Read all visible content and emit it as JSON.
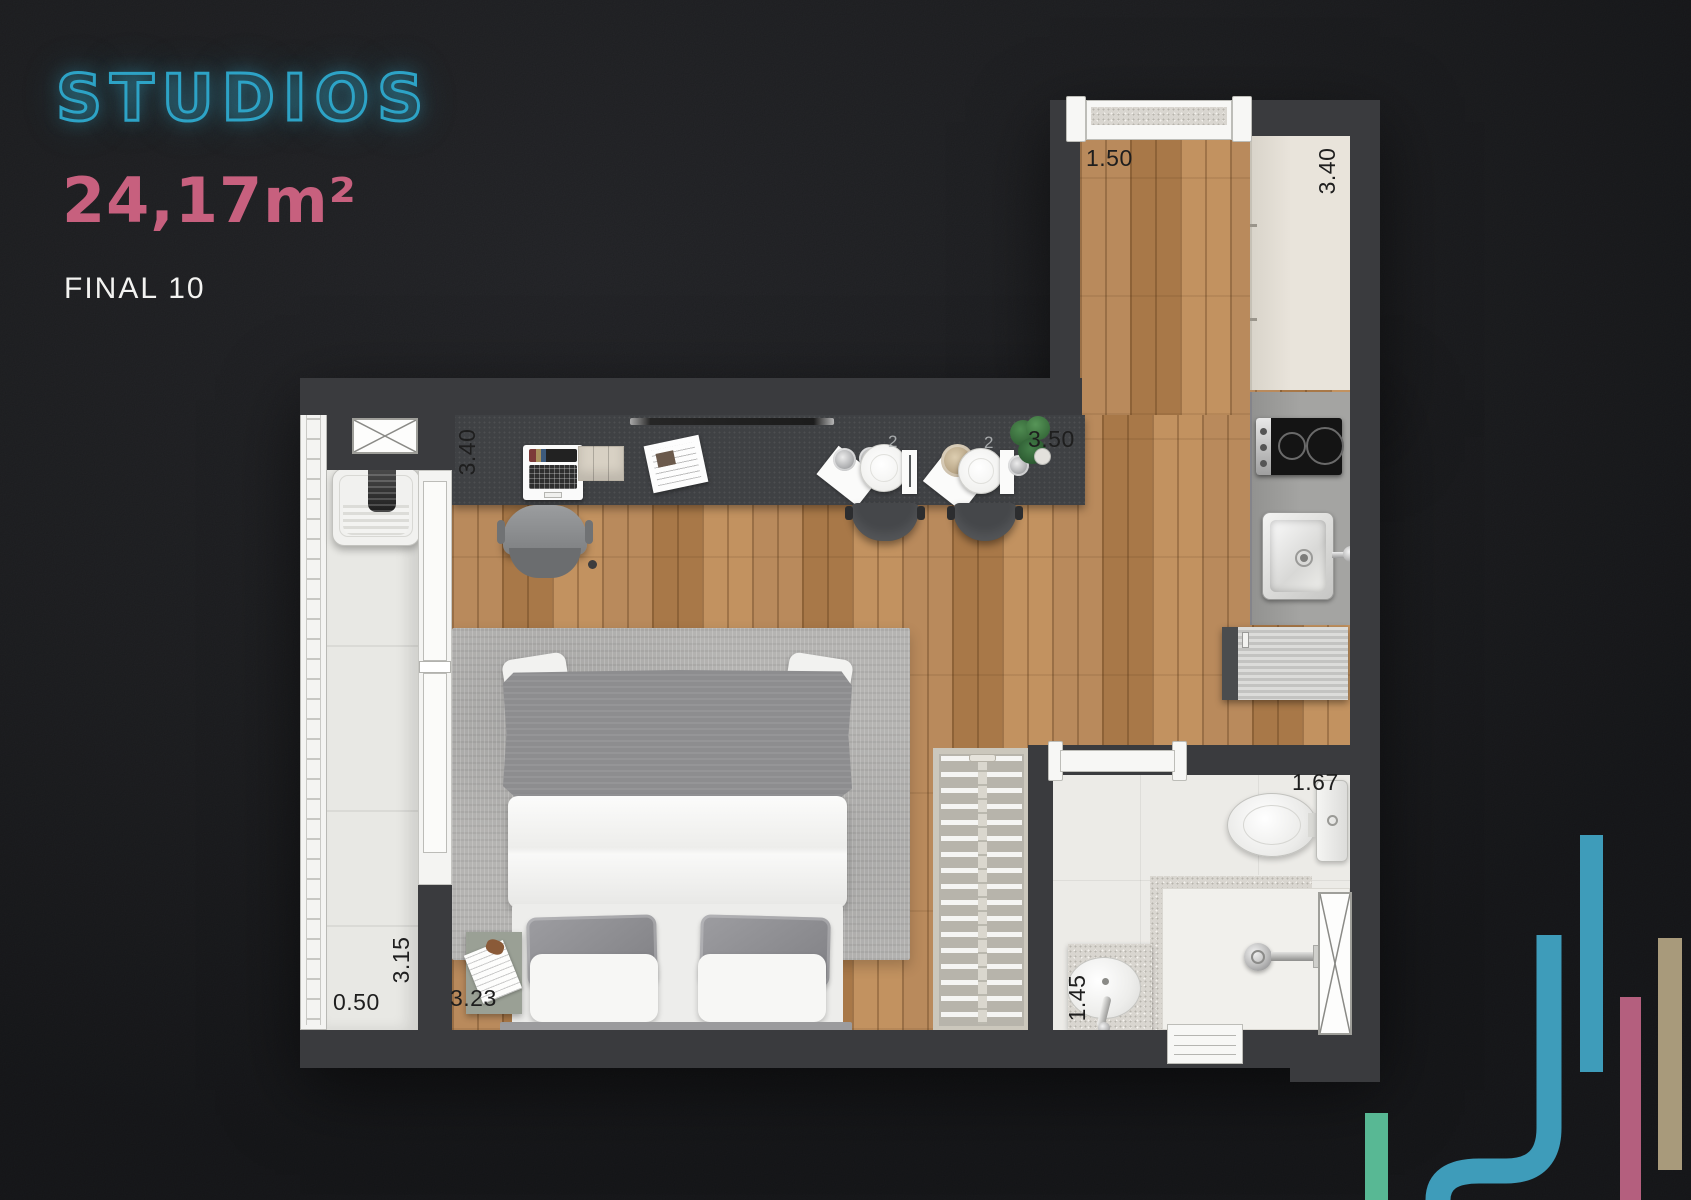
{
  "branding": {
    "title": "STUDIOS",
    "area": "24,17m²",
    "unit": "FINAL 10",
    "title_color": "#2da3c6",
    "area_color": "#c7607e"
  },
  "floorplan": {
    "dimensions": {
      "top_window": "1.50",
      "kitchen_wall": "3.40",
      "desk_wall": "3.40",
      "living_length": "3.50",
      "balcony_length": "3.15",
      "balcony_width": "0.50",
      "bedroom_width": "3.23",
      "bathroom_width": "1.45",
      "bathroom_length": "1.67"
    },
    "decor_marks": {
      "steam_left": "2",
      "steam_right": "2"
    },
    "palette": {
      "wall": "#3a3b3e",
      "wood": "#b2824f",
      "tile": "#ecebe7",
      "balcony_floor": "#e8e8e4",
      "rug": "#b5b4b2"
    }
  },
  "graphic_bars": {
    "colors": {
      "teal": "#3e9cba",
      "pink": "#b45f7e",
      "tan": "#a89a7b",
      "green": "#58b894"
    }
  }
}
